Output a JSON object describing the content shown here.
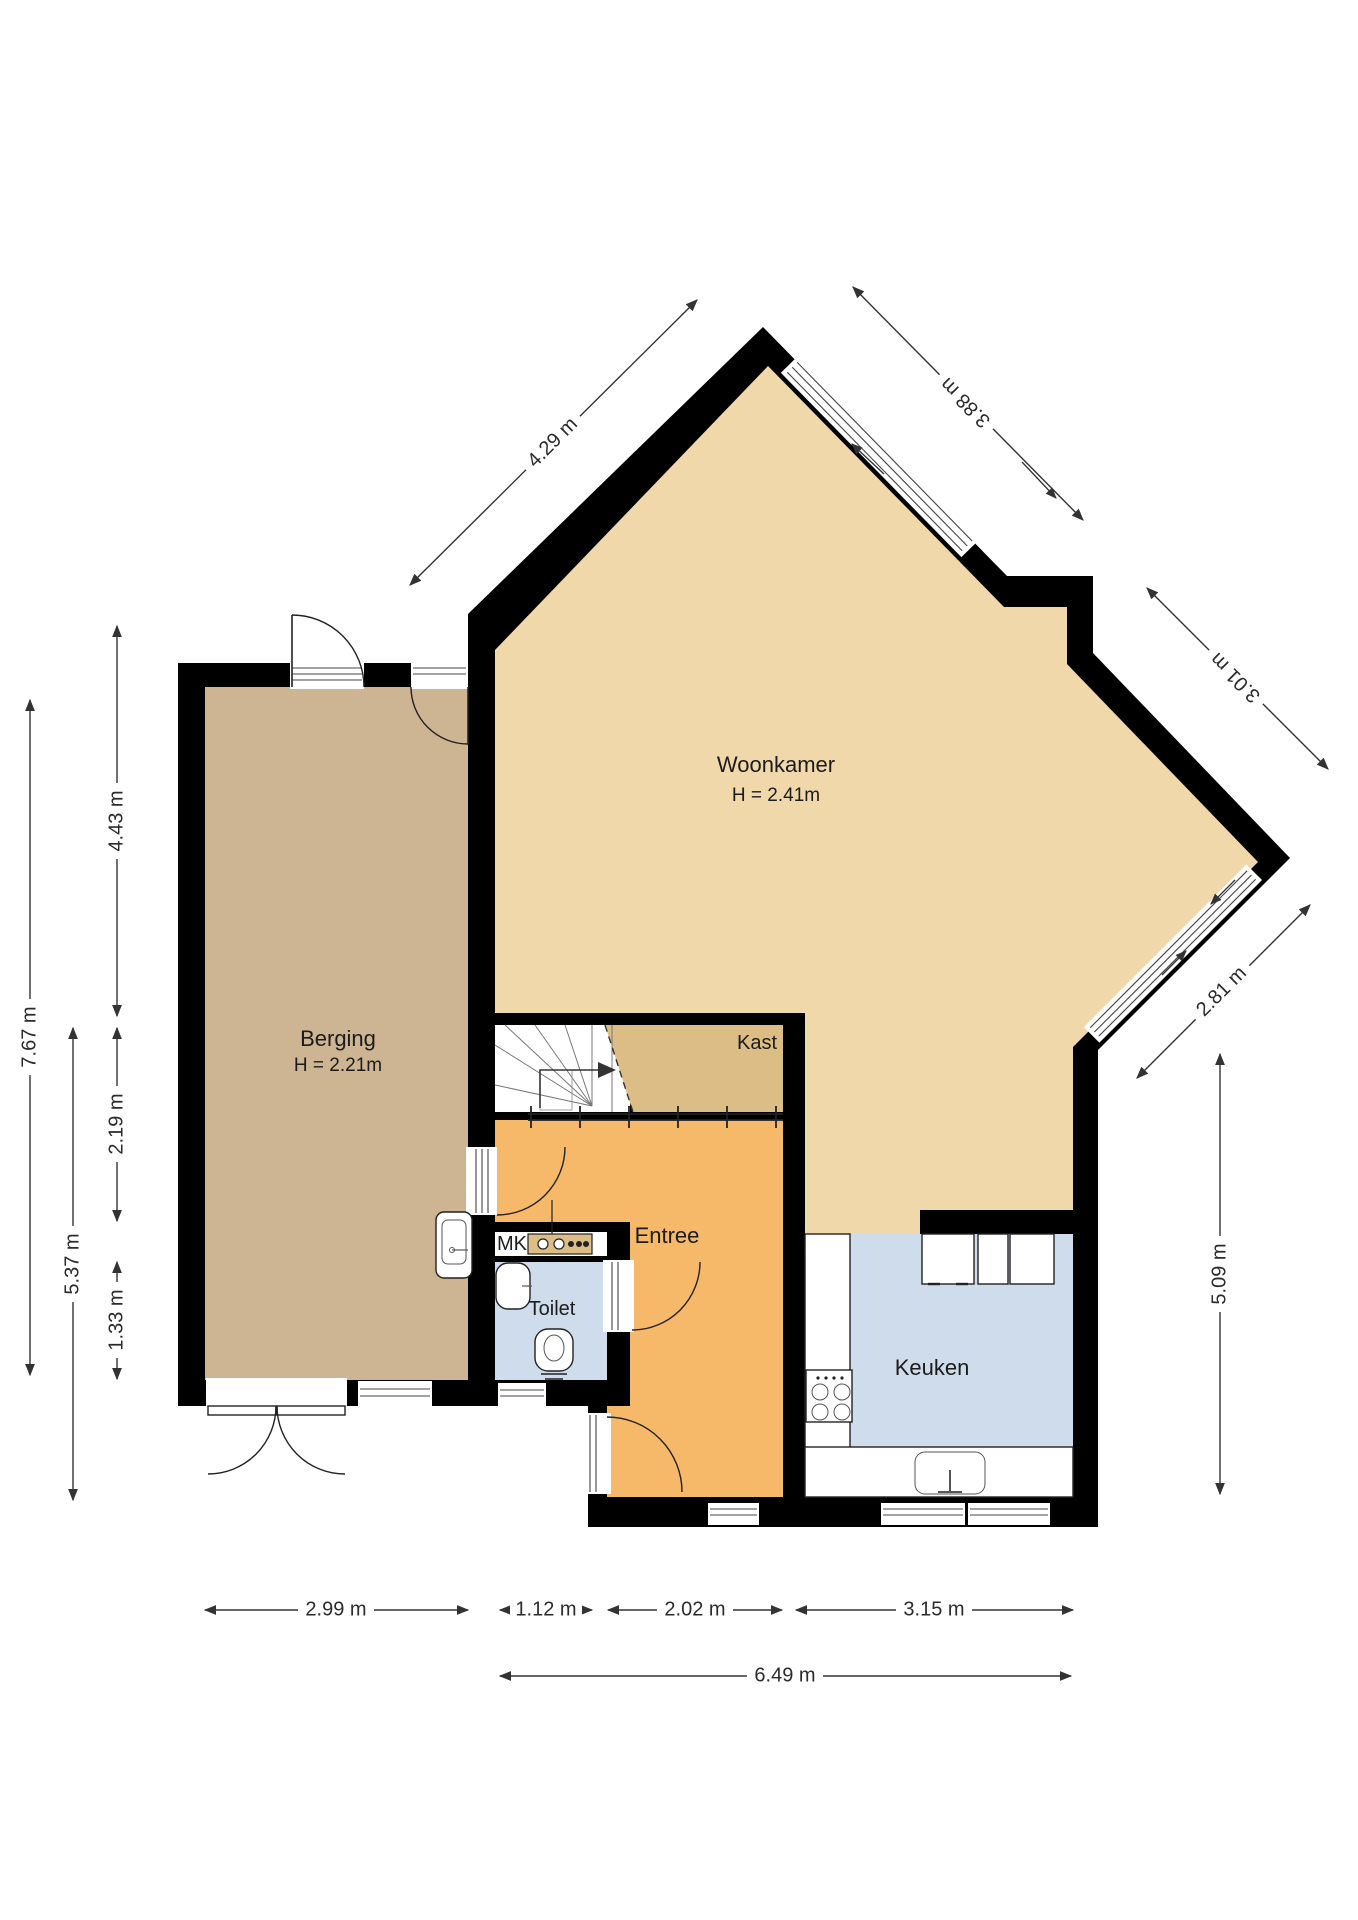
{
  "rooms": {
    "woonkamer": {
      "label": "Woonkamer",
      "height": "H = 2.41m"
    },
    "berging": {
      "label": "Berging",
      "height": "H = 2.21m"
    },
    "entree": {
      "label": "Entree"
    },
    "toilet": {
      "label": "Toilet"
    },
    "keuken": {
      "label": "Keuken"
    },
    "kast": {
      "label": "Kast"
    },
    "meterkast": {
      "label": "MK"
    }
  },
  "dimensions": {
    "left_outer": "7.67 m",
    "left_inner": "5.37 m",
    "left_top": "4.43 m",
    "left_middle": "2.19 m",
    "left_bottom": "1.33 m",
    "diag_top_left": "4.29 m",
    "diag_top_right": "3.88 m",
    "diag_right_upper": "3.01 m",
    "diag_right_lower": "2.81 m",
    "right_vertical": "5.09 m",
    "bottom_berging": "2.99 m",
    "bottom_hall": "1.12 m",
    "bottom_entree": "2.02 m",
    "bottom_keuken": "3.15 m",
    "bottom_total": "6.49 m"
  },
  "colors": {
    "wall": "#000000",
    "woonkamer": "#f0d8ab",
    "berging": "#cdb492",
    "kast": "#ddbd86",
    "entree": "#f6b96a",
    "wet_rooms": "#cfdcec",
    "background": "#ffffff"
  }
}
